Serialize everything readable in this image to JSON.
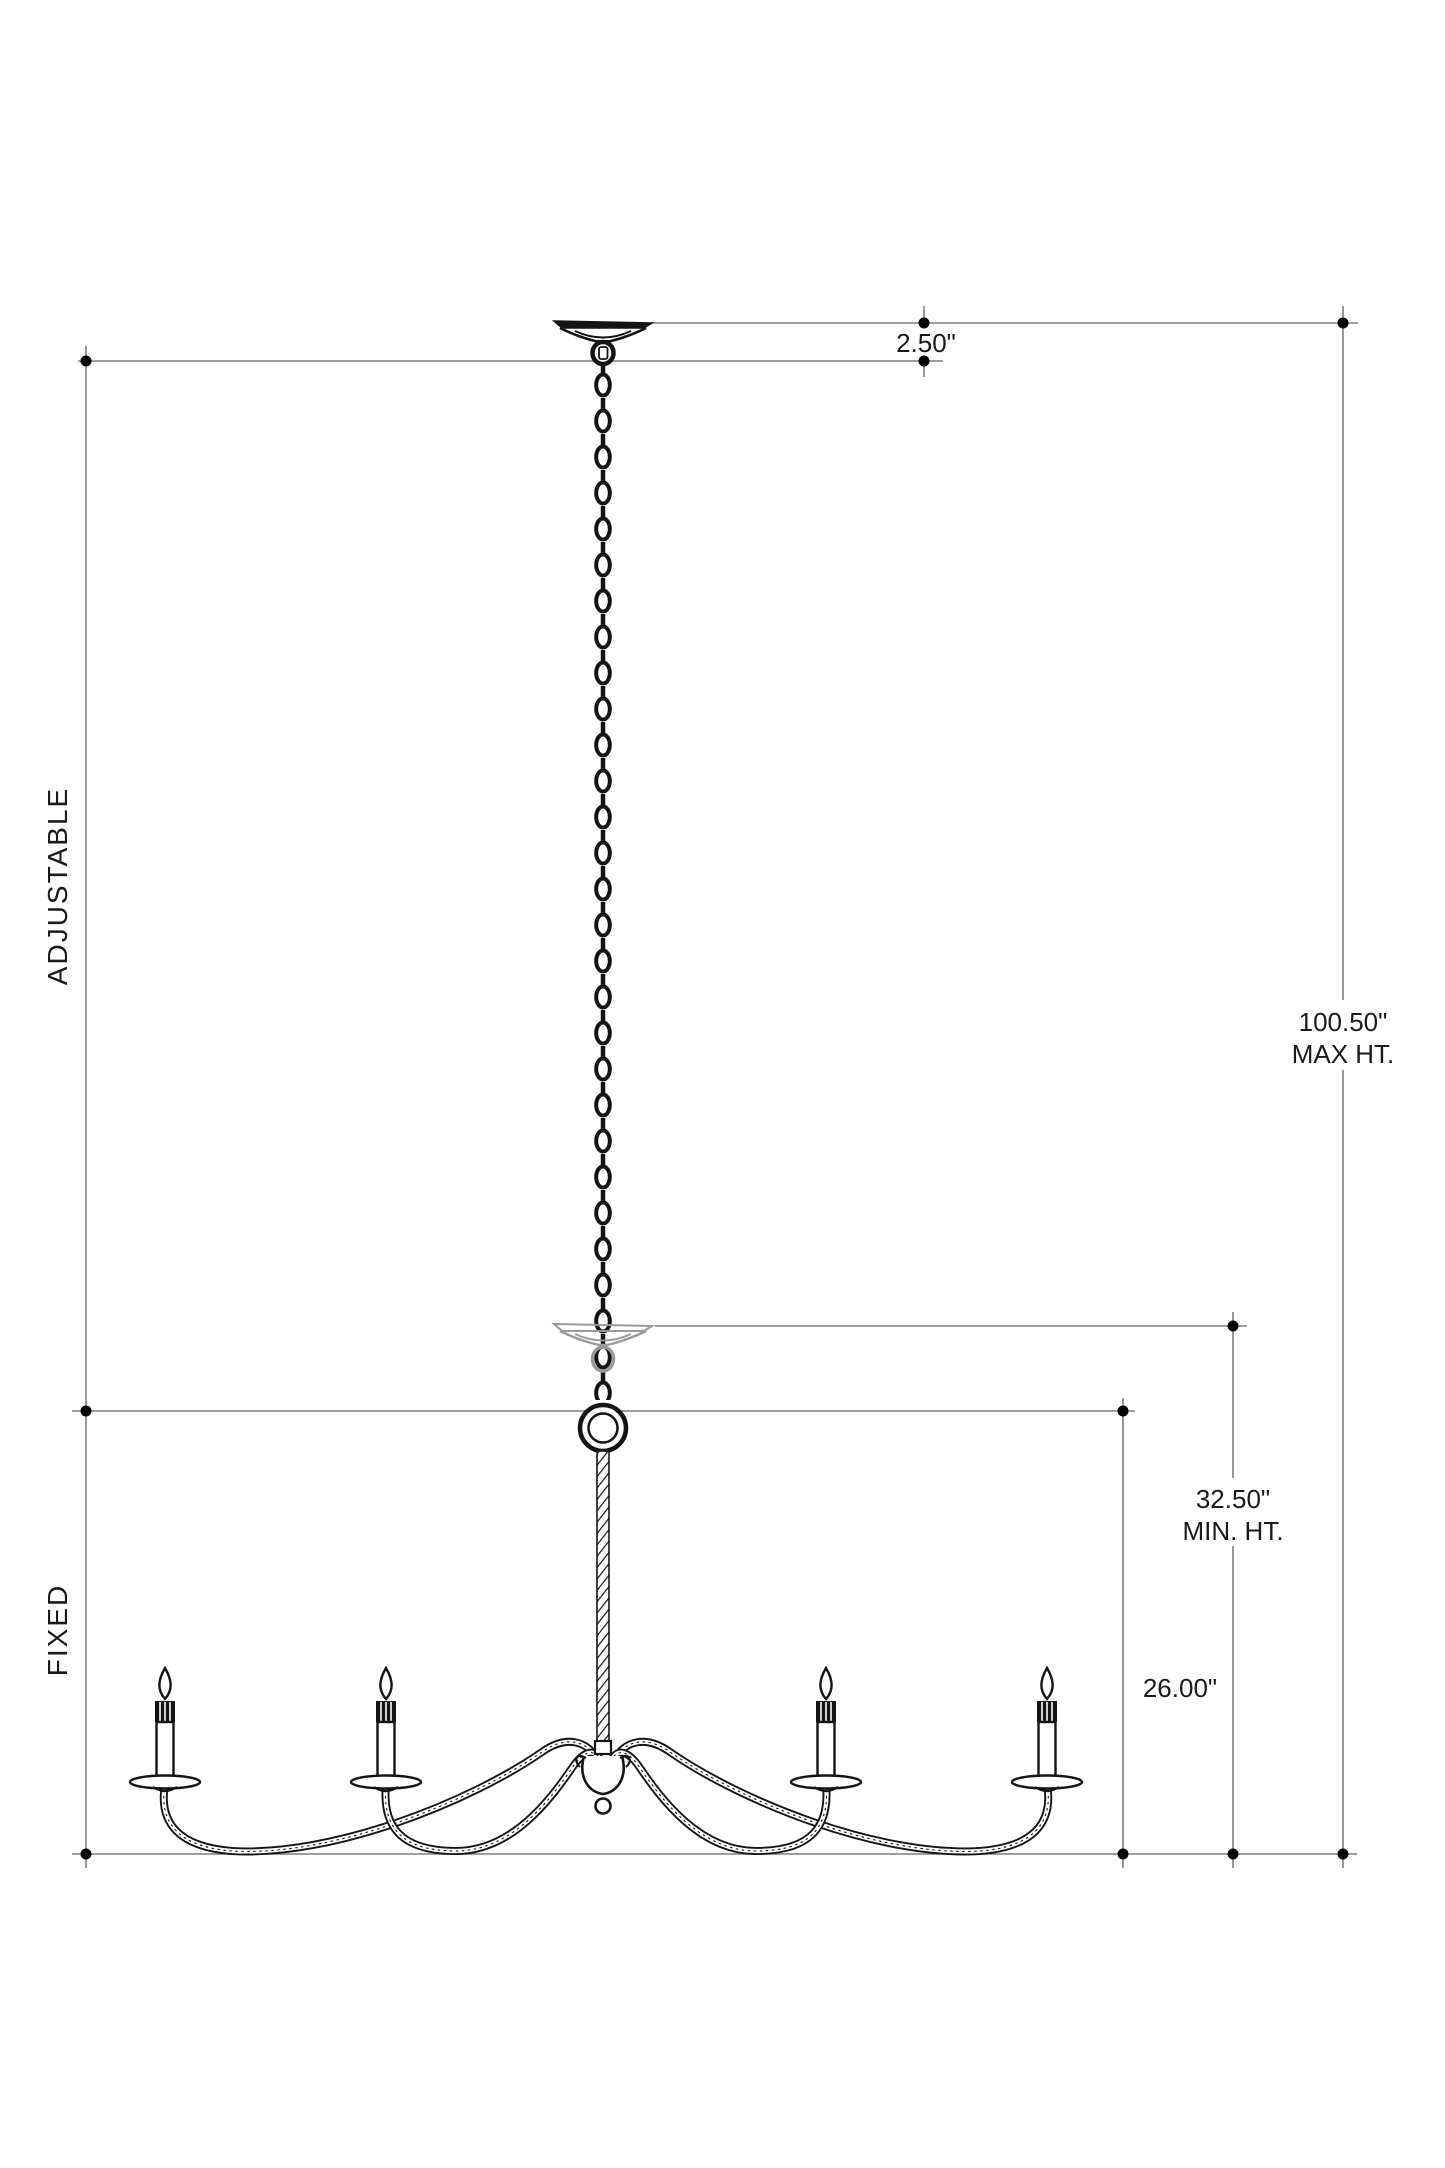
{
  "diagram": {
    "kind": "chandelier-installation-dimension-drawing",
    "labels": {
      "canopy_height": "2.50\"",
      "max_height_value": "100.50\"",
      "max_height_label": "MAX HT.",
      "min_height_value": "32.50\"",
      "min_height_label": "MIN. HT.",
      "body_height": "26.00\"",
      "adjustable": "ADJUSTABLE",
      "fixed": "FIXED"
    },
    "colors": {
      "fixture": "#141414",
      "dimension_line": "#7f7f7f",
      "dimension_dot": "#000000",
      "ghost_canopy": "#9a9a9a",
      "text": "#1a1a1a",
      "background": "#ffffff"
    },
    "fixture": {
      "candle_count": 4,
      "style": "four-arm scrolled chandelier on chain with twisted-rope stem"
    }
  }
}
